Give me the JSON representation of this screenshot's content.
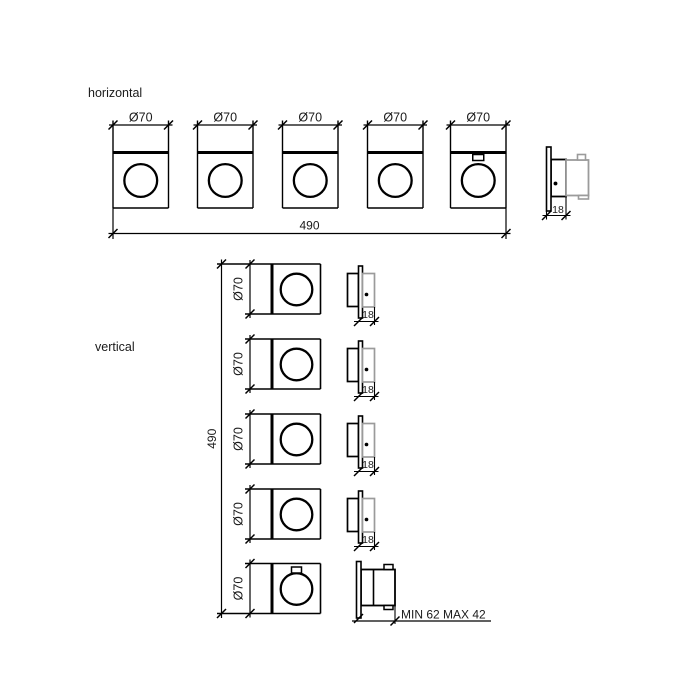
{
  "colors": {
    "line": "#000000",
    "gray": "#9b9b9b",
    "text": "#1a1a1a",
    "background": "#ffffff"
  },
  "horizontal_section": {
    "label": "horizontal",
    "overall_width": "490",
    "units": [
      {
        "dia": "Ø70"
      },
      {
        "dia": "Ø70"
      },
      {
        "dia": "Ø70"
      },
      {
        "dia": "Ø70"
      },
      {
        "dia": "Ø70",
        "handle_tab": true
      }
    ],
    "side_view": {
      "depth": "18"
    }
  },
  "vertical_section": {
    "label": "vertical",
    "overall_height": "490",
    "units": [
      {
        "dia": "Ø70",
        "side_depth": "18"
      },
      {
        "dia": "Ø70",
        "side_depth": "18"
      },
      {
        "dia": "Ø70",
        "side_depth": "18"
      },
      {
        "dia": "Ø70",
        "side_depth": "18"
      },
      {
        "dia": "Ø70",
        "side_note": "MIN 62 MAX 42",
        "handle_tab": true
      }
    ]
  }
}
